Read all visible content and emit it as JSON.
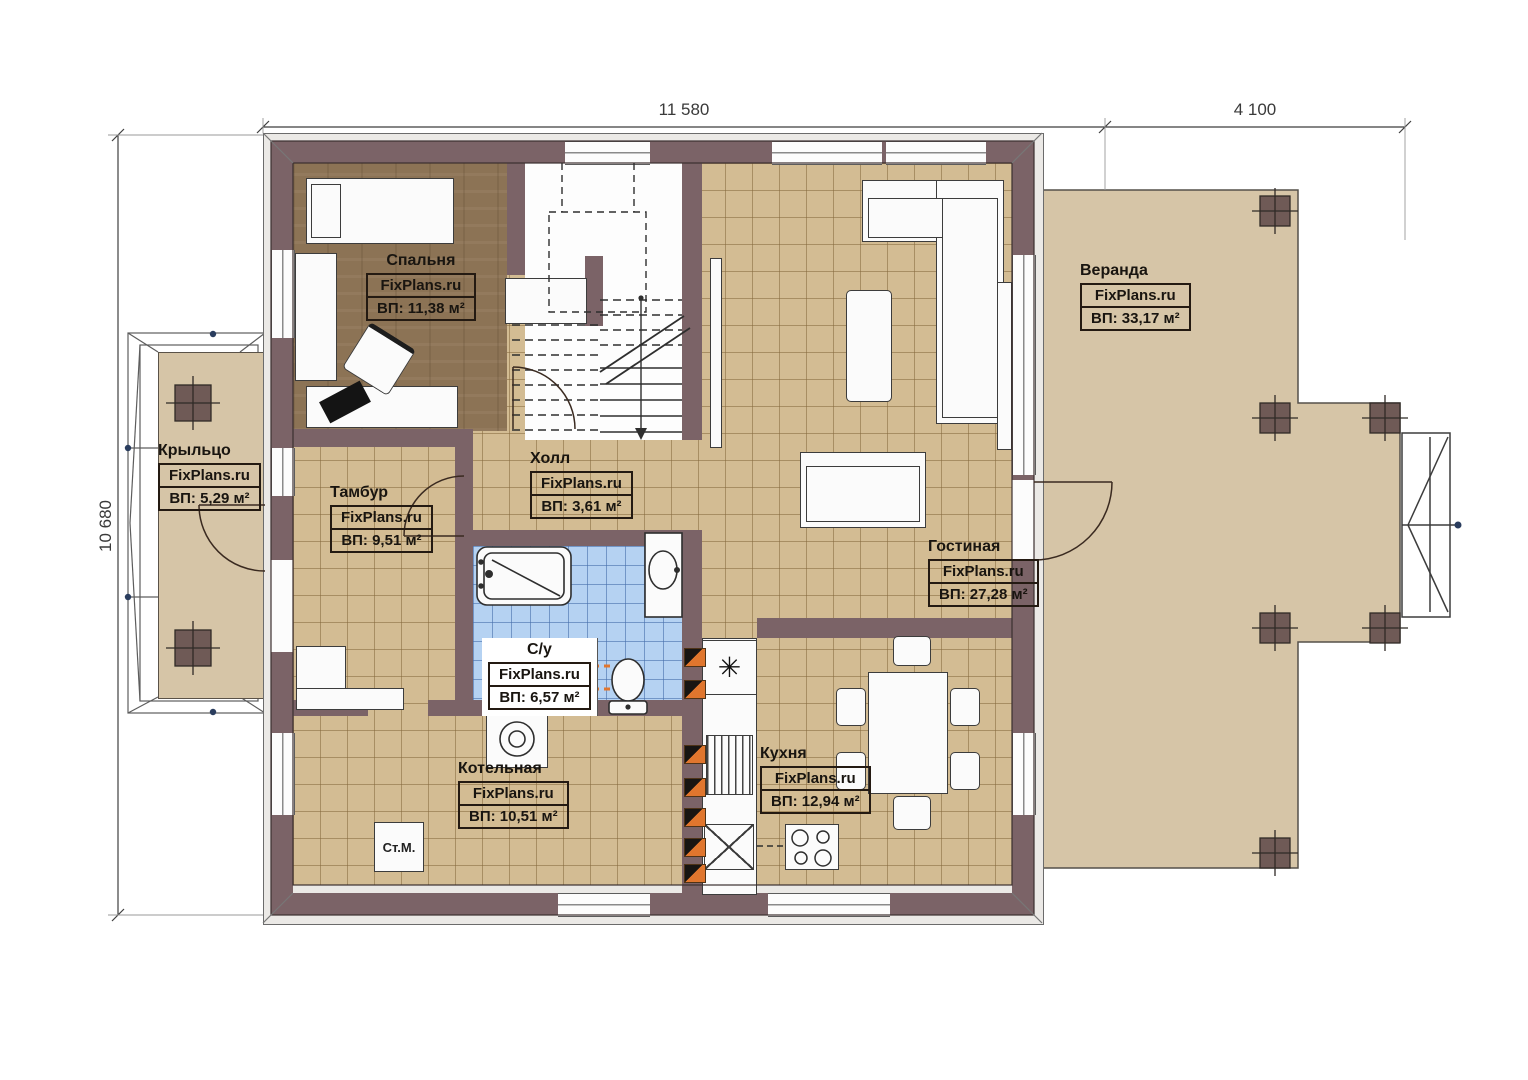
{
  "brand": "FixPlans.ru",
  "dimensions": {
    "top_main": "11 580",
    "top_veranda": "4 100",
    "left_height": "10 680"
  },
  "rooms": [
    {
      "id": "bedroom",
      "name": "Спальня",
      "brand": "FixPlans.ru",
      "area": "ВП: 11,38 м²"
    },
    {
      "id": "veranda",
      "name": "Веранда",
      "brand": "FixPlans.ru",
      "area": "ВП: 33,17 м²"
    },
    {
      "id": "porch",
      "name": "Крыльцо",
      "brand": "FixPlans.ru",
      "area": "ВП: 5,29 м²"
    },
    {
      "id": "tambour",
      "name": "Тамбур",
      "brand": "FixPlans.ru",
      "area": "ВП: 9,51 м²"
    },
    {
      "id": "hall",
      "name": "Холл",
      "brand": "FixPlans.ru",
      "area": "ВП: 3,61 м²"
    },
    {
      "id": "living",
      "name": "Гостиная",
      "brand": "FixPlans.ru",
      "area": "ВП: 27,28 м²"
    },
    {
      "id": "wc",
      "name": "С/у",
      "brand": "FixPlans.ru",
      "area": "ВП: 6,57 м²"
    },
    {
      "id": "boiler",
      "name": "Котельная",
      "brand": "FixPlans.ru",
      "area": "ВП: 10,51 м²"
    },
    {
      "id": "kitchen",
      "name": "Кухня",
      "brand": "FixPlans.ru",
      "area": "ВП: 12,94 м²"
    }
  ],
  "symbols": {
    "washing_machine": "Ст.М.",
    "vent": "✳"
  },
  "colors": {
    "wall": "#7b6367",
    "band": "#ebe9e6",
    "tile": "#d3bc93",
    "tileline": "rgba(132,104,60,0.55)",
    "wood": "#8c7355",
    "bathtile": "#b5d2f2",
    "bathline": "rgba(70,110,170,0.6)",
    "deck": "#d6c5a7",
    "post": "#6f5a56",
    "marker": "#e0762e"
  }
}
